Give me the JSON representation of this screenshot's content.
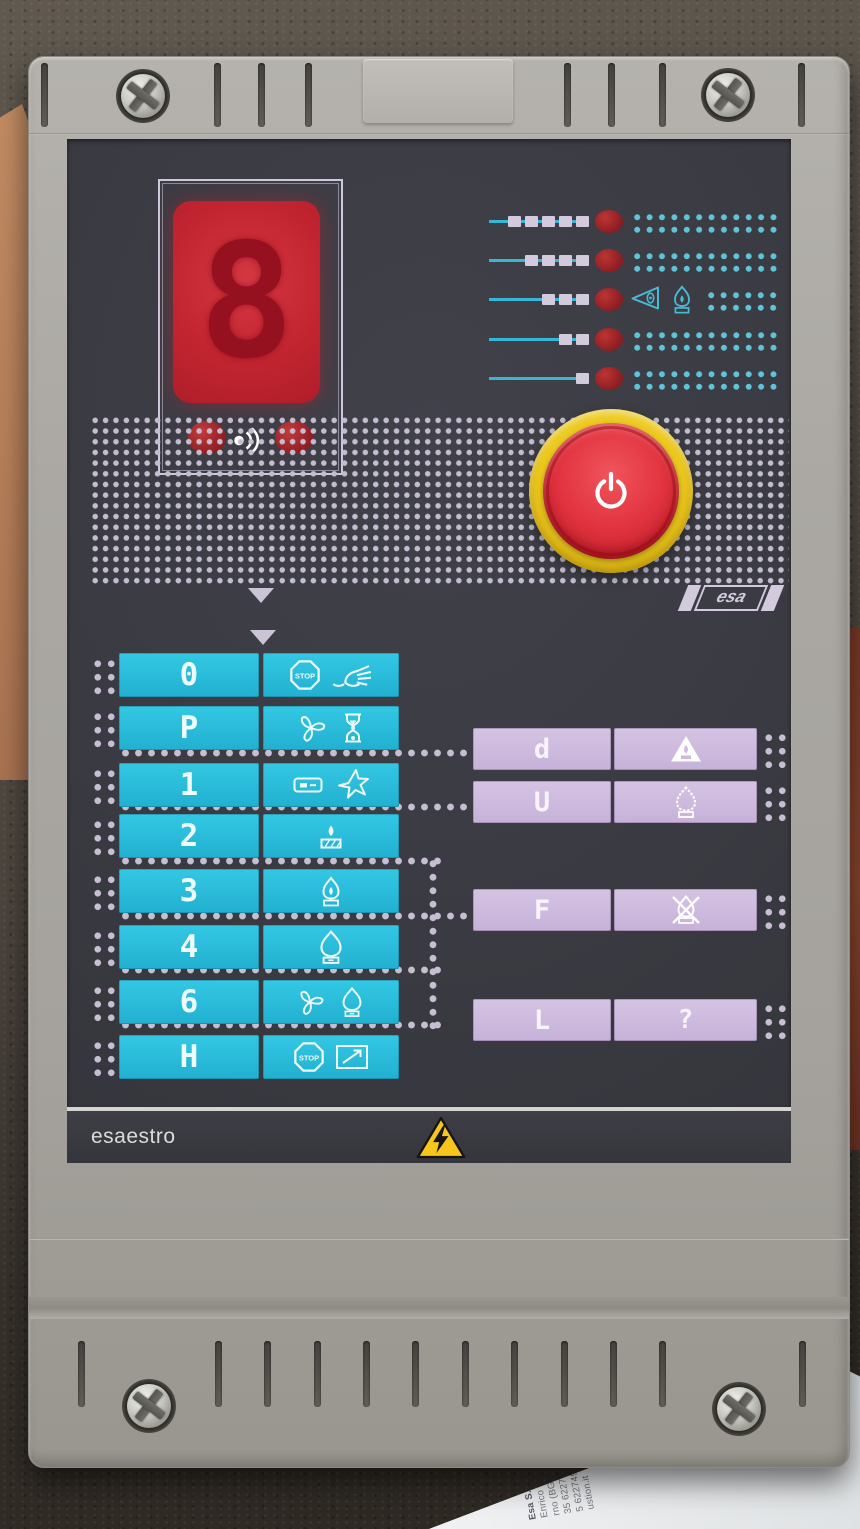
{
  "device": {
    "brand": "esa",
    "model_label": "esaestro",
    "stop_text": "STOP",
    "display": {
      "digit": "8",
      "status_leds": [
        "red",
        "red"
      ],
      "sound_icon": "sound-waves-icon"
    },
    "level_indicators": [
      {
        "segments": 5,
        "led": "red",
        "icons": []
      },
      {
        "segments": 4,
        "led": "red",
        "icons": []
      },
      {
        "segments": 3,
        "led": "red",
        "icons": [
          "eye-triangle-icon",
          "flame-chamber-icon"
        ]
      },
      {
        "segments": 2,
        "led": "red",
        "icons": []
      },
      {
        "segments": 1,
        "led": "red",
        "icons": []
      }
    ],
    "power_button": {
      "icon": "power-icon",
      "ring_color": "#f2d228",
      "button_color": "#e63741"
    },
    "mode_rows": [
      {
        "label": "0",
        "icons": [
          "stop-icon",
          "hand-manual-icon"
        ]
      },
      {
        "label": "P",
        "icons": [
          "fan-icon",
          "hourglass-icon"
        ]
      },
      {
        "label": "1",
        "icons": [
          "ignition-transformer-icon",
          "spark-icon"
        ]
      },
      {
        "label": "2",
        "icons": [
          "pilot-flame-icon"
        ]
      },
      {
        "label": "3",
        "icons": [
          "low-flame-icon"
        ]
      },
      {
        "label": "4",
        "icons": [
          "high-flame-icon"
        ]
      },
      {
        "label": "6",
        "icons": [
          "fan-icon",
          "high-flame-icon"
        ]
      },
      {
        "label": "H",
        "icons": [
          "stop-icon",
          "ramp-arrow-icon"
        ]
      }
    ],
    "param_rows": [
      {
        "label": "d",
        "icons": [
          "flame-triangle-icon"
        ]
      },
      {
        "label": "U",
        "icons": [
          "flame-dotted-icon"
        ]
      },
      {
        "label": "F",
        "icons": [
          "flame-crossed-icon"
        ]
      },
      {
        "label": "L",
        "icons": [
          "question-mark"
        ],
        "symbol": "?"
      }
    ],
    "footer": {
      "brand_text": "esaestro",
      "warning_icon": "high-voltage-triangle-icon"
    },
    "colors": {
      "panel": "#3a3a41",
      "housing": "#aba8a3",
      "button_cyan": "#2cc3e0",
      "button_purple": "#cebade",
      "dot_lavender": "#c6bfd2",
      "dot_cyan": "#5ec4da",
      "led_red": "#a3242a",
      "display_red": "#c5242e",
      "power_ring": "#f2d228",
      "power_button": "#e63741",
      "warning_yellow": "#f6c61c"
    }
  },
  "paper": {
    "lines": [
      "Esa S.p.A.",
      "Enrico Fermi 40",
      "rno (BG) - Italy",
      "35 6227411",
      "5 6227499",
      "ustion.it"
    ]
  }
}
